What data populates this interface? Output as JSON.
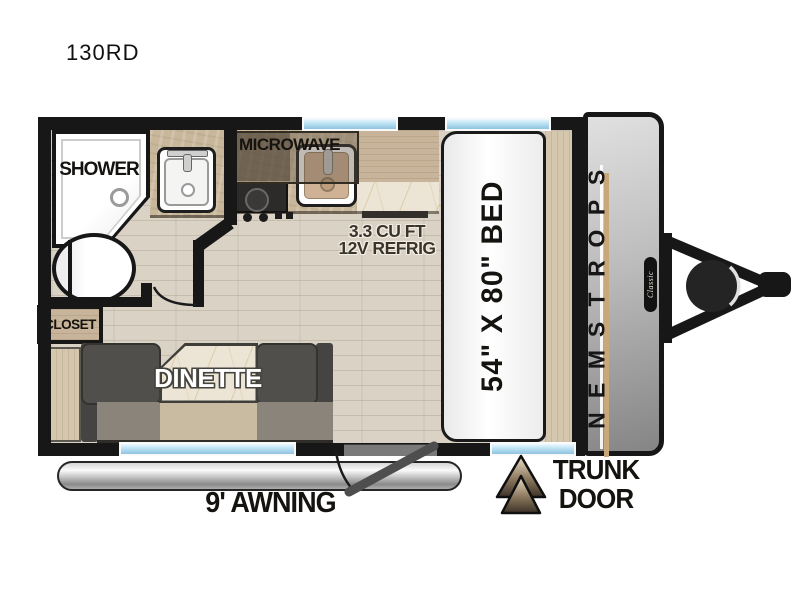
{
  "model": "130RD",
  "bathroom": {
    "shower": "SHOWER",
    "closet": "CLOSET"
  },
  "kitchen": {
    "microwave": "MICROWAVE",
    "refrig_line1": "3.3 CU FT",
    "refrig_line2": "12V REFRIG"
  },
  "dinette": {
    "label": "DINETTE"
  },
  "bedroom": {
    "bed": "54\" X 80\" BED"
  },
  "exterior": {
    "awning": "9' AWNING",
    "trunk_line1": "TRUNK",
    "trunk_line2": "DOOR",
    "brand": "SPORTSMEN",
    "series": "Classic"
  },
  "colors": {
    "wall": "#171717",
    "floor": "#d9d2c5",
    "counter_tan": "#c8b79b",
    "marble": "#ece4d4",
    "window_blue": "#9fd0e8",
    "seat_gray": "#514f4c",
    "cap_gray": "#b5b5b5",
    "accent_tan": "#c8a77b",
    "arrow_light": "#eee1cb",
    "arrow_dark": "#3c3227"
  }
}
